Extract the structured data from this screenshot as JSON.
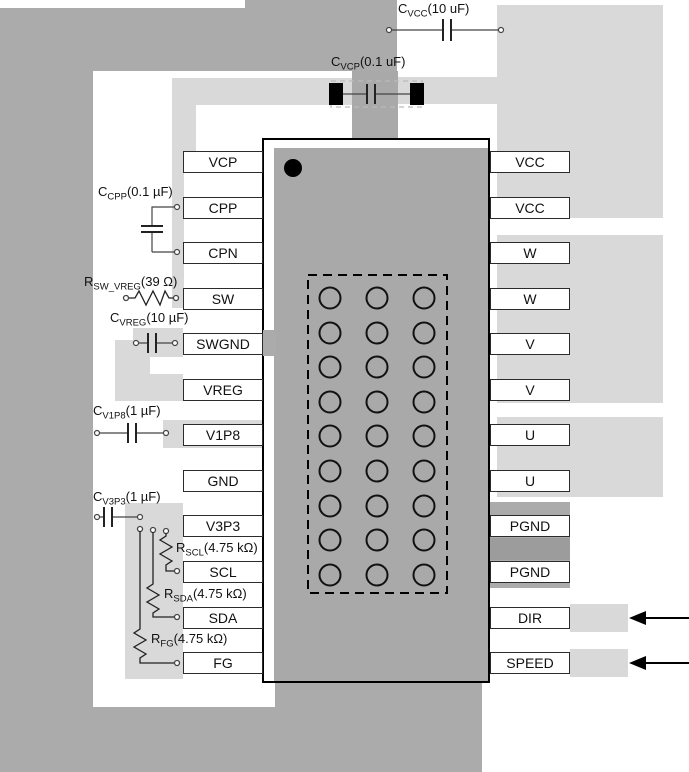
{
  "diagram": {
    "ic": {
      "left_pins": [
        "VCP",
        "CPP",
        "CPN",
        "SW",
        "SWGND",
        "VREG",
        "V1P8",
        "GND",
        "V3P3",
        "SCL",
        "SDA",
        "FG"
      ],
      "right_pins": [
        "VCC",
        "VCC",
        "W",
        "W",
        "V",
        "V",
        "U",
        "U",
        "PGND",
        "PGND",
        "DIR",
        "SPEED"
      ],
      "thermal_pad": {
        "rows": 9,
        "cols": 3
      }
    },
    "components": [
      {
        "id": "cvcc",
        "prefix": "C",
        "sub": "VCC",
        "value": "(10 uF)"
      },
      {
        "id": "cvcp",
        "prefix": "C",
        "sub": "VCP",
        "value": "(0.1 uF)"
      },
      {
        "id": "ccpp",
        "prefix": "C",
        "sub": "CPP",
        "value": "(0.1 µF)"
      },
      {
        "id": "rswvreg",
        "prefix": "R",
        "sub": "SW_VREG",
        "value": "(39 Ω)"
      },
      {
        "id": "cvreg",
        "prefix": "C",
        "sub": "VREG",
        "value": "(10 µF)"
      },
      {
        "id": "cv1p8",
        "prefix": "C",
        "sub": "V1P8",
        "value": "(1 µF)"
      },
      {
        "id": "cv3p3",
        "prefix": "C",
        "sub": "V3P3",
        "value": "(1 µF)"
      },
      {
        "id": "rscl",
        "prefix": "R",
        "sub": "SCL",
        "value": "(4.75 kΩ)"
      },
      {
        "id": "rsda",
        "prefix": "R",
        "sub": "SDA",
        "value": "(4.75 kΩ)"
      },
      {
        "id": "rfg",
        "prefix": "R",
        "sub": "FG",
        "value": "(4.75 kΩ)"
      }
    ],
    "input_arrow_pins": [
      "DIR",
      "SPEED"
    ],
    "colors": {
      "board_gray": "#ababab",
      "pour_light": "#d9d9d9",
      "pour_dark": "#9c9c9c",
      "ic_gray": "#a9a9a9"
    }
  }
}
